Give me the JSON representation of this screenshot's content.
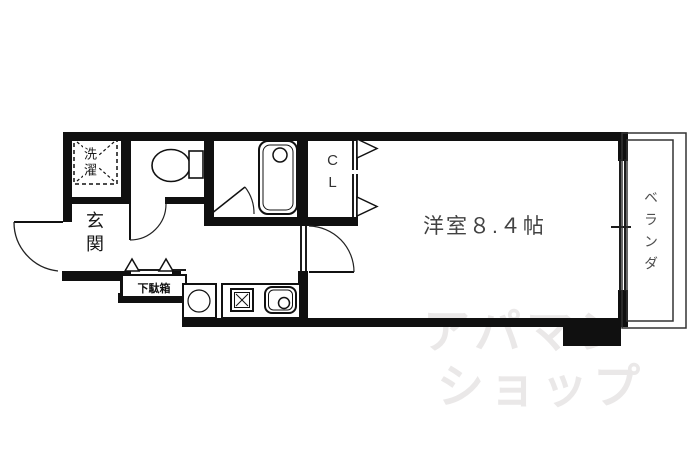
{
  "floorplan": {
    "type": "apartment-floor-plan",
    "rooms": {
      "laundry": {
        "label": "洗濯"
      },
      "entrance": {
        "label": "玄関"
      },
      "shoebox": {
        "label": "下駄箱"
      },
      "closet": {
        "label": "CL"
      },
      "main_room": {
        "label": "洋室８.４帖"
      },
      "veranda": {
        "label": "ベランダ"
      }
    },
    "fixtures": [
      "washing-machine-area",
      "toilet",
      "bathtub",
      "refrigerator-space",
      "stove",
      "kitchen-sink",
      "shoe-cabinet"
    ],
    "watermark": {
      "line1": "アパマン",
      "line2": "ショップ"
    },
    "colors": {
      "background": "#ffffff",
      "wall": "#101010",
      "line": "#1c1c1c",
      "label": "#424242",
      "watermark": "#eae8e8"
    }
  }
}
